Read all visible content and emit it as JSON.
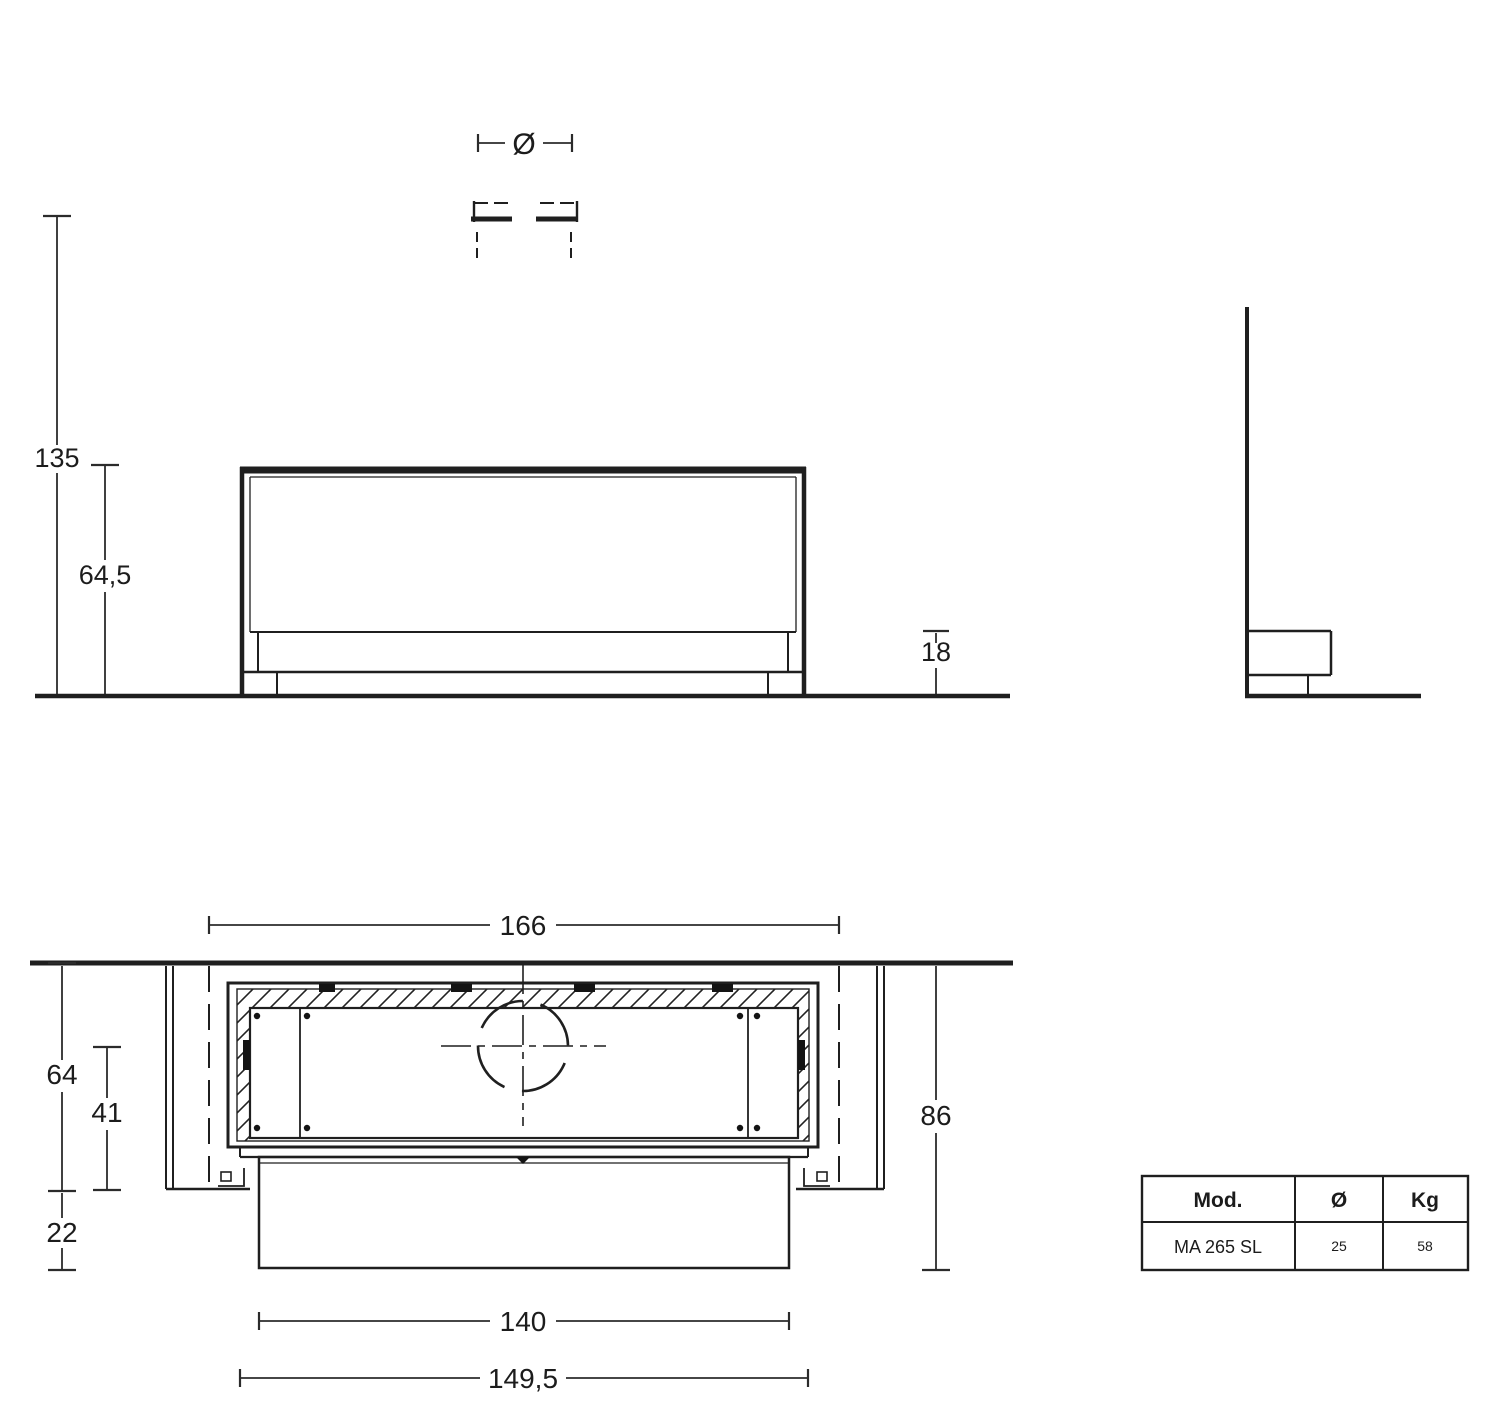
{
  "page": {
    "background": "#ffffff",
    "line_color": "#1f1f1f"
  },
  "flue_symbol": {
    "diameter_label": "Ø"
  },
  "front_view": {
    "dim_ceiling_height": "135",
    "dim_unit_height": "64,5",
    "dim_plinth_height": "18"
  },
  "plan_view": {
    "dim_recess_width": "166",
    "dim_recess_depth": "64",
    "dim_inner_depth": "41",
    "dim_front_protrusion": "22",
    "dim_total_depth": "86",
    "dim_front_panel_width": "140",
    "dim_frame_width": "149,5"
  },
  "spec_table": {
    "headers": [
      "Mod.",
      "Ø",
      "Kg"
    ],
    "row": [
      "MA 265 SL",
      "25",
      "58"
    ]
  }
}
